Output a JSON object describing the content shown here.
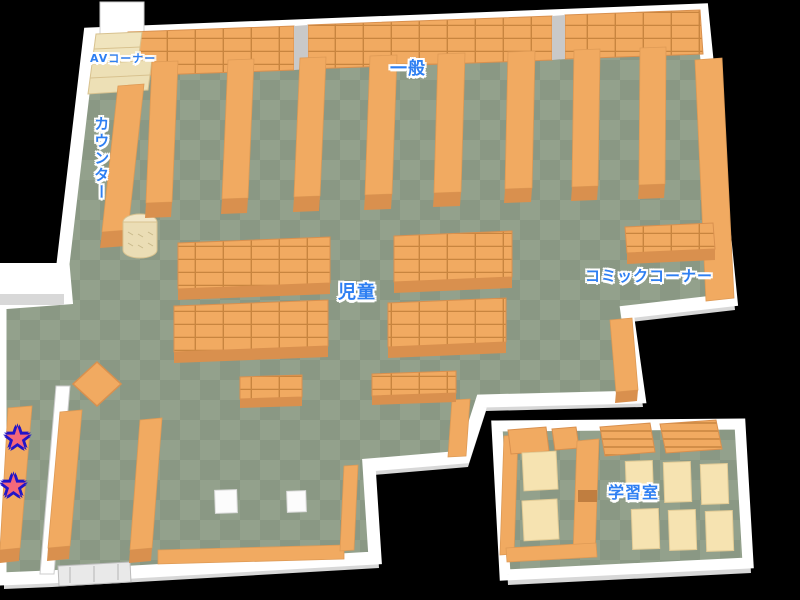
{
  "areas": {
    "av_corner": {
      "label": "AVコーナー"
    },
    "general": {
      "label": "一般"
    },
    "counter": {
      "label": "カウンター"
    },
    "children": {
      "label": "児童"
    },
    "comic_corner": {
      "label": "コミックコーナー"
    },
    "study_room": {
      "label": "学習室"
    }
  },
  "markers": {
    "star_glyph": "★",
    "star_count": 2
  },
  "colors": {
    "background": "#000000",
    "floor_dark": "#8A9884",
    "floor_light": "#93A18C",
    "wall": "#FFFFFF",
    "wall_shadow": "#D8D8D8",
    "shelf": "#F1AA61",
    "shelf_front": "#D9904E",
    "shelf_line": "#C8853F",
    "av_shelf_cream": "#F0E4BD",
    "desk_cream": "#F6E3B1",
    "label_text": "#2E7FF2",
    "label_outline": "#FFFFFF",
    "star_fill": "#F4687A",
    "star_outline": "#2214C8"
  }
}
